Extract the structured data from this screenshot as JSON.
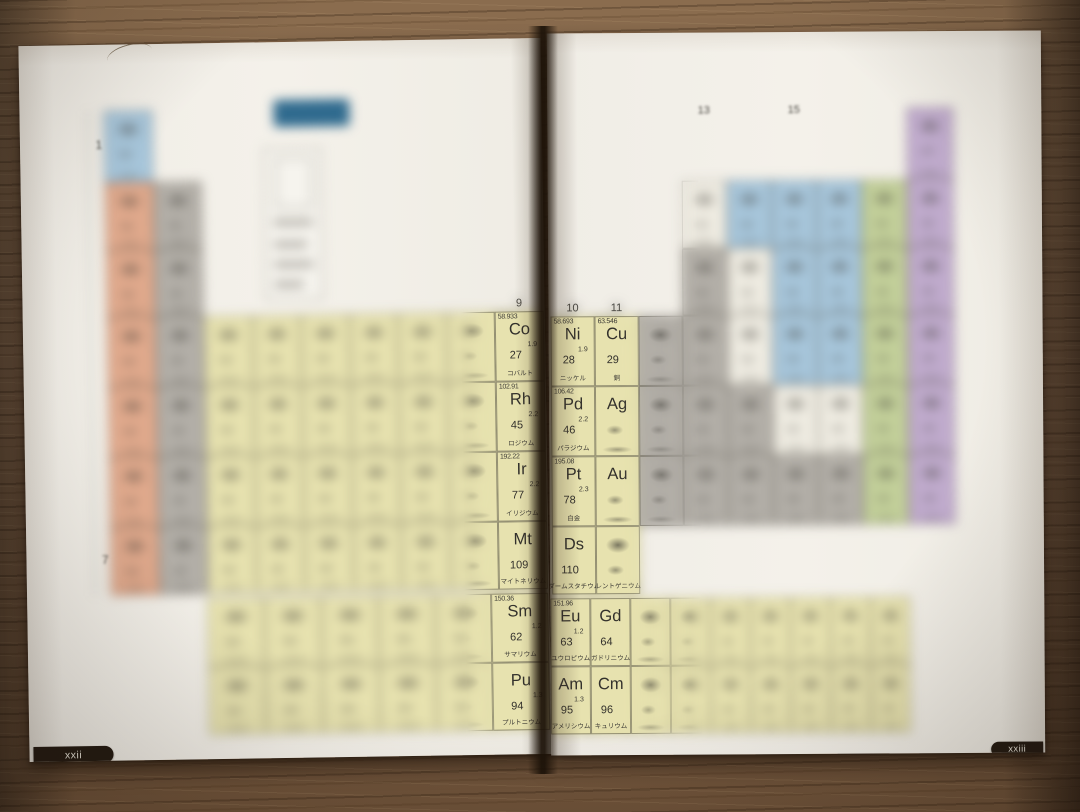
{
  "photo": {
    "left_tab": "xxii",
    "right_tab": "xxiii"
  },
  "colors": {
    "yellow": "#e7e2af",
    "orange": "#e0a98c",
    "gray": "#b3afa8",
    "blue": "#a7c6db",
    "green": "#c3d09a",
    "purple": "#c0abcd",
    "white": "#efece2",
    "title_block": "#2f6a8e",
    "tab": "#241b12",
    "paper": "#f2efe8"
  },
  "group_labels": [
    {
      "page": "left",
      "group": 9,
      "label": "9",
      "sharp": true
    },
    {
      "page": "right",
      "group": 10,
      "label": "10",
      "sharp": true
    },
    {
      "page": "right",
      "group": 11,
      "label": "11",
      "sharp": true
    },
    {
      "page": "right",
      "group": 13,
      "label": "13",
      "sharp": false
    },
    {
      "page": "right",
      "group": 15,
      "label": "15",
      "sharp": false
    }
  ],
  "period_labels": [
    {
      "period": 1,
      "label": "1"
    },
    {
      "period": 7,
      "label": "7"
    }
  ],
  "legend": {
    "rows": [
      {
        "color": "#b39bc7",
        "bar": 118
      },
      {
        "color": "#b5c98e",
        "bar": 92
      },
      {
        "color": "#9ec3dc",
        "bar": 148
      },
      {
        "color": "#e2b07e",
        "bar": 64
      },
      {
        "color": "#d9886a",
        "bar": 100,
        "fragment": "こともあ",
        "bar2": 170
      },
      {
        "color": "#e7e1a8",
        "bar": 150
      },
      {
        "color": "#b2ada5",
        "bar": 64
      }
    ]
  },
  "elements": [
    {
      "p": "L",
      "g": 9,
      "r": 4,
      "c": "yellow",
      "w": "58.933",
      "s": "Co",
      "e": "1.9",
      "n": "27",
      "nm": "コバルト"
    },
    {
      "p": "L",
      "g": 9,
      "r": 5,
      "c": "yellow",
      "w": "102.91",
      "s": "Rh",
      "e": "2.2",
      "n": "45",
      "nm": "ロジウム"
    },
    {
      "p": "L",
      "g": 9,
      "r": 6,
      "c": "yellow",
      "w": "192.22",
      "s": "Ir",
      "e": "2.2",
      "n": "77",
      "nm": "イリジウム"
    },
    {
      "p": "L",
      "g": 9,
      "r": 7,
      "c": "yellow",
      "s": "Mt",
      "n": "109",
      "nm": "マイトネリウム"
    },
    {
      "p": "L",
      "g": 6,
      "r": "lan",
      "c": "yellow",
      "w": "150.36",
      "s": "Sm",
      "e": "1.2",
      "n": "62",
      "nm": "サマリウム"
    },
    {
      "p": "L",
      "g": 6,
      "r": "act",
      "c": "yellow",
      "s": "Pu",
      "e": "1.3",
      "n": "94",
      "nm": "プルトニウム"
    },
    {
      "p": "R",
      "g": 10,
      "r": 4,
      "c": "yellow",
      "w": "58.693",
      "s": "Ni",
      "e": "1.9",
      "n": "28",
      "nm": "ニッケル"
    },
    {
      "p": "R",
      "g": 11,
      "r": 4,
      "c": "yellow",
      "w": "63.546",
      "s": "Cu",
      "n": "29",
      "nm": "銅"
    },
    {
      "p": "R",
      "g": 10,
      "r": 5,
      "c": "yellow",
      "w": "106.42",
      "s": "Pd",
      "e": "2.2",
      "n": "46",
      "nm": "パラジウム"
    },
    {
      "p": "R",
      "g": 11,
      "r": 5,
      "c": "yellow",
      "s": "Ag"
    },
    {
      "p": "R",
      "g": 10,
      "r": 6,
      "c": "yellow",
      "w": "195.08",
      "s": "Pt",
      "e": "2.3",
      "n": "78",
      "nm": "白金"
    },
    {
      "p": "R",
      "g": 11,
      "r": 6,
      "c": "yellow",
      "s": "Au"
    },
    {
      "p": "R",
      "g": 10,
      "r": 7,
      "c": "yellow",
      "s": "Ds",
      "n": "110",
      "nm": "ダームスタチウム"
    },
    {
      "p": "R",
      "g": 11,
      "r": 7,
      "c": "yellow",
      "nm": "レントゲニウム"
    },
    {
      "p": "R",
      "g": 1,
      "r": "lan",
      "c": "yellow",
      "w": "151.96",
      "s": "Eu",
      "e": "1.2",
      "n": "63",
      "nm": "ユウロピウム"
    },
    {
      "p": "R",
      "g": 2,
      "r": "lan",
      "c": "yellow",
      "s": "Gd",
      "n": "64",
      "nm": "ガドリニウム"
    },
    {
      "p": "R",
      "g": 1,
      "r": "act",
      "c": "yellow",
      "s": "Am",
      "e": "1.3",
      "n": "95",
      "nm": "アメリシウム"
    },
    {
      "p": "R",
      "g": 2,
      "r": "act",
      "c": "yellow",
      "s": "Cm",
      "n": "96",
      "nm": "キュリウム"
    }
  ],
  "blurred_tiles": [
    {
      "p": "L",
      "g": 1,
      "r": 1,
      "c": "blue"
    },
    {
      "p": "L",
      "g": 1,
      "r": 2,
      "c": "orange"
    },
    {
      "p": "L",
      "g": 2,
      "r": 2,
      "c": "gray"
    },
    {
      "p": "L",
      "g": 1,
      "r": 3,
      "c": "orange"
    },
    {
      "p": "L",
      "g": 2,
      "r": 3,
      "c": "gray"
    },
    {
      "p": "L",
      "g": 1,
      "r": 4,
      "c": "orange"
    },
    {
      "p": "L",
      "g": 2,
      "r": 4,
      "c": "gray"
    },
    {
      "p": "L",
      "g": 3,
      "r": 4,
      "c": "yellow"
    },
    {
      "p": "L",
      "g": 4,
      "r": 4,
      "c": "yellow"
    },
    {
      "p": "L",
      "g": 5,
      "r": 4,
      "c": "yellow"
    },
    {
      "p": "L",
      "g": 6,
      "r": 4,
      "c": "yellow"
    },
    {
      "p": "L",
      "g": 7,
      "r": 4,
      "c": "yellow"
    },
    {
      "p": "L",
      "g": 8,
      "r": 4,
      "c": "yellow"
    },
    {
      "p": "L",
      "g": 1,
      "r": 5,
      "c": "orange"
    },
    {
      "p": "L",
      "g": 2,
      "r": 5,
      "c": "gray"
    },
    {
      "p": "L",
      "g": 3,
      "r": 5,
      "c": "yellow"
    },
    {
      "p": "L",
      "g": 4,
      "r": 5,
      "c": "yellow"
    },
    {
      "p": "L",
      "g": 5,
      "r": 5,
      "c": "yellow"
    },
    {
      "p": "L",
      "g": 6,
      "r": 5,
      "c": "yellow"
    },
    {
      "p": "L",
      "g": 7,
      "r": 5,
      "c": "yellow"
    },
    {
      "p": "L",
      "g": 8,
      "r": 5,
      "c": "yellow"
    },
    {
      "p": "L",
      "g": 1,
      "r": 6,
      "c": "orange"
    },
    {
      "p": "L",
      "g": 2,
      "r": 6,
      "c": "gray"
    },
    {
      "p": "L",
      "g": 3,
      "r": 6,
      "c": "yellow"
    },
    {
      "p": "L",
      "g": 4,
      "r": 6,
      "c": "yellow"
    },
    {
      "p": "L",
      "g": 5,
      "r": 6,
      "c": "yellow"
    },
    {
      "p": "L",
      "g": 6,
      "r": 6,
      "c": "yellow"
    },
    {
      "p": "L",
      "g": 7,
      "r": 6,
      "c": "yellow"
    },
    {
      "p": "L",
      "g": 8,
      "r": 6,
      "c": "yellow"
    },
    {
      "p": "L",
      "g": 1,
      "r": 7,
      "c": "orange"
    },
    {
      "p": "L",
      "g": 2,
      "r": 7,
      "c": "gray"
    },
    {
      "p": "L",
      "g": 3,
      "r": 7,
      "c": "yellow"
    },
    {
      "p": "L",
      "g": 4,
      "r": 7,
      "c": "yellow"
    },
    {
      "p": "L",
      "g": 5,
      "r": 7,
      "c": "yellow"
    },
    {
      "p": "L",
      "g": 6,
      "r": 7,
      "c": "yellow"
    },
    {
      "p": "L",
      "g": 7,
      "r": 7,
      "c": "yellow"
    },
    {
      "p": "L",
      "g": 8,
      "r": 7,
      "c": "yellow"
    },
    {
      "p": "L",
      "g": 1,
      "r": "lan",
      "c": "yellow"
    },
    {
      "p": "L",
      "g": 2,
      "r": "lan",
      "c": "yellow"
    },
    {
      "p": "L",
      "g": 3,
      "r": "lan",
      "c": "yellow"
    },
    {
      "p": "L",
      "g": 4,
      "r": "lan",
      "c": "yellow"
    },
    {
      "p": "L",
      "g": 5,
      "r": "lan",
      "c": "yellow"
    },
    {
      "p": "L",
      "g": 1,
      "r": "act",
      "c": "yellow"
    },
    {
      "p": "L",
      "g": 2,
      "r": "act",
      "c": "yellow"
    },
    {
      "p": "L",
      "g": 3,
      "r": "act",
      "c": "yellow"
    },
    {
      "p": "L",
      "g": 4,
      "r": "act",
      "c": "yellow"
    },
    {
      "p": "L",
      "g": 5,
      "r": "act",
      "c": "yellow"
    },
    {
      "p": "R",
      "g": 18,
      "r": 1,
      "c": "purple"
    },
    {
      "p": "R",
      "g": 13,
      "r": 2,
      "c": "white"
    },
    {
      "p": "R",
      "g": 14,
      "r": 2,
      "c": "blue"
    },
    {
      "p": "R",
      "g": 15,
      "r": 2,
      "c": "blue"
    },
    {
      "p": "R",
      "g": 16,
      "r": 2,
      "c": "blue"
    },
    {
      "p": "R",
      "g": 17,
      "r": 2,
      "c": "green"
    },
    {
      "p": "R",
      "g": 18,
      "r": 2,
      "c": "purple"
    },
    {
      "p": "R",
      "g": 13,
      "r": 3,
      "c": "gray"
    },
    {
      "p": "R",
      "g": 14,
      "r": 3,
      "c": "white"
    },
    {
      "p": "R",
      "g": 15,
      "r": 3,
      "c": "blue"
    },
    {
      "p": "R",
      "g": 16,
      "r": 3,
      "c": "blue"
    },
    {
      "p": "R",
      "g": 17,
      "r": 3,
      "c": "green"
    },
    {
      "p": "R",
      "g": 18,
      "r": 3,
      "c": "purple"
    },
    {
      "p": "R",
      "g": 12,
      "r": 4,
      "c": "gray"
    },
    {
      "p": "R",
      "g": 13,
      "r": 4,
      "c": "gray"
    },
    {
      "p": "R",
      "g": 14,
      "r": 4,
      "c": "white"
    },
    {
      "p": "R",
      "g": 15,
      "r": 4,
      "c": "blue"
    },
    {
      "p": "R",
      "g": 16,
      "r": 4,
      "c": "blue"
    },
    {
      "p": "R",
      "g": 17,
      "r": 4,
      "c": "green"
    },
    {
      "p": "R",
      "g": 18,
      "r": 4,
      "c": "purple"
    },
    {
      "p": "R",
      "g": 12,
      "r": 5,
      "c": "gray"
    },
    {
      "p": "R",
      "g": 13,
      "r": 5,
      "c": "gray"
    },
    {
      "p": "R",
      "g": 14,
      "r": 5,
      "c": "gray"
    },
    {
      "p": "R",
      "g": 15,
      "r": 5,
      "c": "white"
    },
    {
      "p": "R",
      "g": 16,
      "r": 5,
      "c": "white"
    },
    {
      "p": "R",
      "g": 17,
      "r": 5,
      "c": "green"
    },
    {
      "p": "R",
      "g": 18,
      "r": 5,
      "c": "purple"
    },
    {
      "p": "R",
      "g": 12,
      "r": 6,
      "c": "gray"
    },
    {
      "p": "R",
      "g": 13,
      "r": 6,
      "c": "gray"
    },
    {
      "p": "R",
      "g": 14,
      "r": 6,
      "c": "gray"
    },
    {
      "p": "R",
      "g": 15,
      "r": 6,
      "c": "gray"
    },
    {
      "p": "R",
      "g": 16,
      "r": 6,
      "c": "gray"
    },
    {
      "p": "R",
      "g": 17,
      "r": 6,
      "c": "green"
    },
    {
      "p": "R",
      "g": 18,
      "r": 6,
      "c": "purple"
    },
    {
      "p": "R",
      "g": 3,
      "r": "lan",
      "c": "yellow"
    },
    {
      "p": "R",
      "g": 4,
      "r": "lan",
      "c": "yellow"
    },
    {
      "p": "R",
      "g": 5,
      "r": "lan",
      "c": "yellow"
    },
    {
      "p": "R",
      "g": 6,
      "r": "lan",
      "c": "yellow"
    },
    {
      "p": "R",
      "g": 7,
      "r": "lan",
      "c": "yellow"
    },
    {
      "p": "R",
      "g": 8,
      "r": "lan",
      "c": "yellow"
    },
    {
      "p": "R",
      "g": 9,
      "r": "lan",
      "c": "yellow"
    },
    {
      "p": "R",
      "g": 3,
      "r": "act",
      "c": "yellow"
    },
    {
      "p": "R",
      "g": 4,
      "r": "act",
      "c": "yellow"
    },
    {
      "p": "R",
      "g": 5,
      "r": "act",
      "c": "yellow"
    },
    {
      "p": "R",
      "g": 6,
      "r": "act",
      "c": "yellow"
    },
    {
      "p": "R",
      "g": 7,
      "r": "act",
      "c": "yellow"
    },
    {
      "p": "R",
      "g": 8,
      "r": "act",
      "c": "yellow"
    },
    {
      "p": "R",
      "g": 9,
      "r": "act",
      "c": "yellow"
    }
  ]
}
